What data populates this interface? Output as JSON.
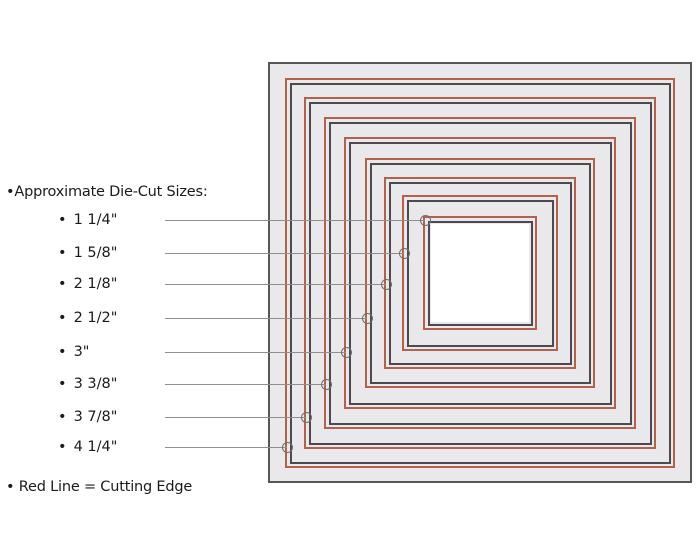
{
  "title": "•Approximate Die-Cut Sizes:",
  "legend": "• Red Line = Cutting Edge",
  "bullet": "•",
  "colors": {
    "cutting_edge_red": "#b4604c",
    "die_edge_dark": "#4c4a50",
    "plate_edge": "#56565a",
    "plate_fill": "#e9e8ea",
    "center_fill": "#ffffff",
    "pointer_line": "#8f8f8f",
    "pointer_circle": "#6e6e6e",
    "text": "#1b1b1b",
    "background": "#ffffff"
  },
  "dies": [
    {
      "label": "1 1/4\"",
      "size_px": 110,
      "pointer_y": 220
    },
    {
      "label": "1 5/8\"",
      "size_px": 152,
      "pointer_y": 253
    },
    {
      "label": "2 1/8\"",
      "size_px": 188,
      "pointer_y": 284
    },
    {
      "label": "2 1/2\"",
      "size_px": 226,
      "pointer_y": 318
    },
    {
      "label": "3\"",
      "size_px": 268,
      "pointer_y": 352
    },
    {
      "label": "3 3/8\"",
      "size_px": 308,
      "pointer_y": 384
    },
    {
      "label": "3 7/8\"",
      "size_px": 348,
      "pointer_y": 417
    },
    {
      "label": "4 1/4\"",
      "size_px": 386,
      "pointer_y": 447
    }
  ],
  "diagram": {
    "plate": {
      "left": 268,
      "top": 62,
      "width": 424,
      "height": 421
    },
    "center_x": 480,
    "center_y": 273,
    "pointer_start_x": 165
  }
}
